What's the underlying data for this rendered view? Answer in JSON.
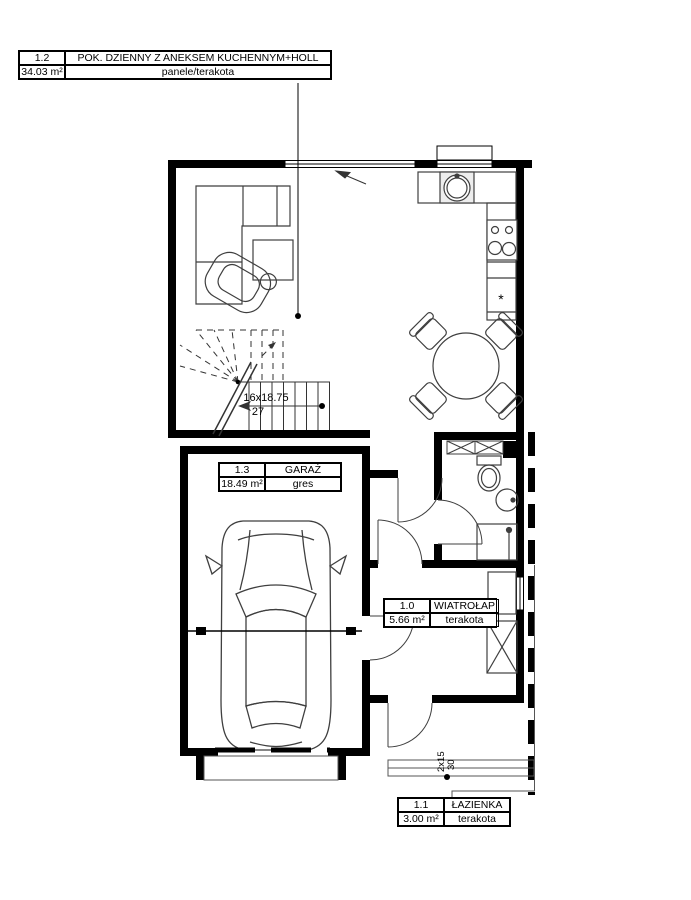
{
  "plan": {
    "rooms": [
      {
        "id": "1.2",
        "name": "POK. DZIENNY Z ANEKSEM KUCHENNYM+HOLL",
        "area": "34.03 m²",
        "finish": "panele/terakota"
      },
      {
        "id": "1.3",
        "name": "GARAŻ",
        "area": "18.49 m²",
        "finish": "gres"
      },
      {
        "id": "1.0",
        "name": "WIATROŁAP",
        "area": "5.66 m²",
        "finish": "terakota"
      },
      {
        "id": "1.1",
        "name": "ŁAZIENKA",
        "area": "3.00 m²",
        "finish": "terakota"
      }
    ],
    "stairs": {
      "run_label": "16x18.75",
      "width_label": "27"
    },
    "entry_steps": {
      "run_label": "2x15",
      "depth_label": "30"
    },
    "kitchen": {
      "freezer_mark": "*"
    }
  },
  "colors": {
    "wall": "#000000",
    "furniture_line": "#3f3f3f",
    "sink_fill": "#ededed"
  }
}
